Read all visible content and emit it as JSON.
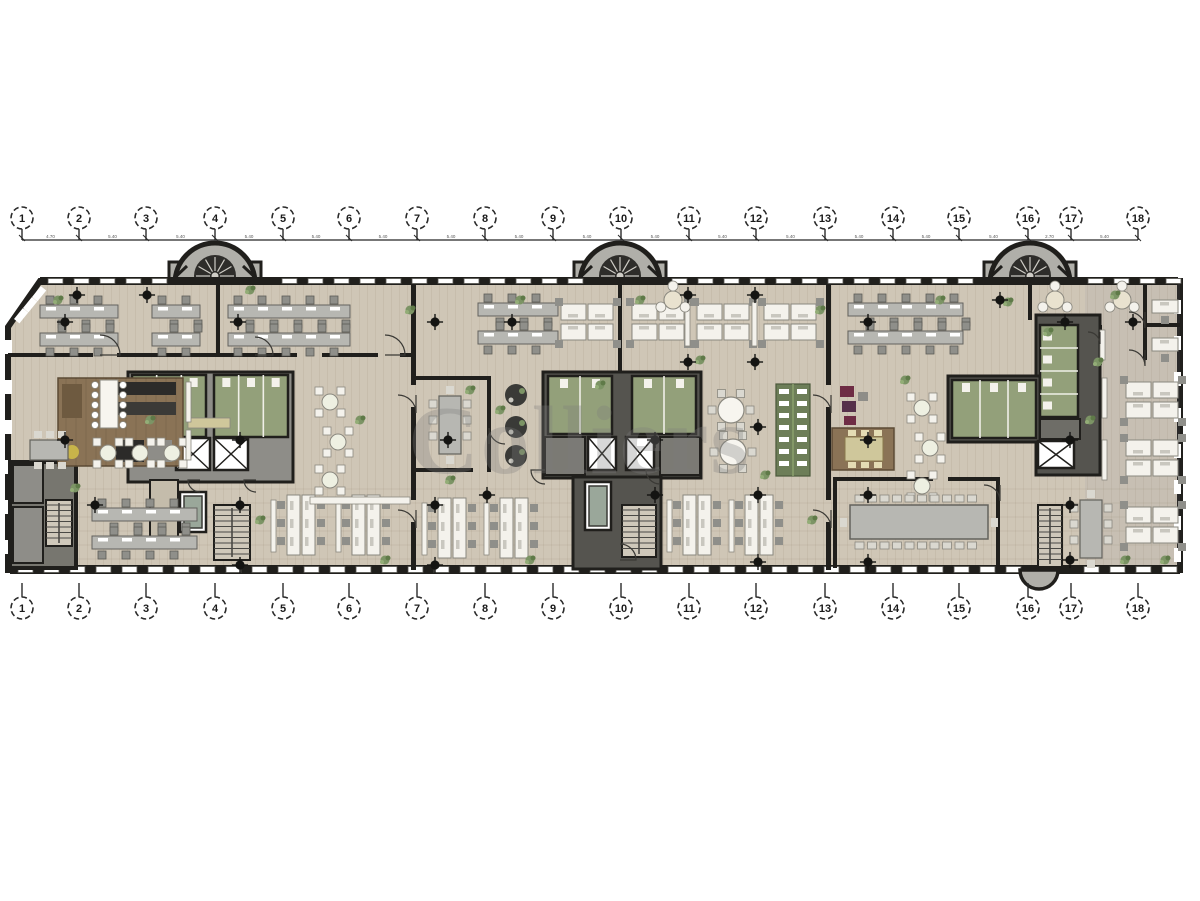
{
  "watermark": {
    "text": "Colliers"
  },
  "palette": {
    "wall": "#201f1c",
    "floor": "#cfc6b6",
    "floor_stripe": "rgba(60,45,20,0.06)",
    "right_tint": "rgba(140,140,155,0.10)",
    "core_dark": "#55544f",
    "core_gray": "#8e8d88",
    "green_room": "#93a07a",
    "green_dark": "#6d7e58",
    "desk_white": "#f4f2ec",
    "desk_gray": "#b7b7b2",
    "chair": "#8f8f8a",
    "chair_light": "#dad8d0",
    "brown": "#8a7356",
    "khaki": "#cfc79b",
    "magenta": "#6e2c44",
    "plant": "#7c9465",
    "tower_gray": "#b0afa9",
    "spiral_dark": "#2e2d2a",
    "spoke": "#cfcdc6",
    "window": "#ffffff",
    "column": "#141412",
    "lift_inner": "#9aa79a",
    "stair_tread": "#cfc8ba"
  },
  "grid": {
    "labels": [
      "1",
      "2",
      "3",
      "4",
      "5",
      "6",
      "7",
      "8",
      "9",
      "10",
      "11",
      "12",
      "13",
      "14",
      "15",
      "16",
      "17",
      "18"
    ],
    "x": [
      22,
      79,
      146,
      215,
      283,
      349,
      417,
      485,
      553,
      621,
      689,
      756,
      825,
      893,
      959,
      1028,
      1071,
      1138
    ],
    "bubble_r": 11,
    "top": {
      "bubble_cy": 218,
      "line_y": 240
    },
    "bottom": {
      "bubble_cy": 608,
      "stem_top": 583
    },
    "dims": [
      "4.70",
      "5.40",
      "5.40",
      "5.40",
      "5.40",
      "5.40",
      "5.40",
      "5.40",
      "5.40",
      "5.40",
      "5.40",
      "5.40",
      "5.40",
      "5.40",
      "5.40",
      "2.70",
      "5.40"
    ]
  },
  "envelope": {
    "points": "40,281 1180,281 1180,570 8,570 8,327"
  },
  "towers": [
    {
      "cx": 215
    },
    {
      "cx": 620
    },
    {
      "cx": 1030
    }
  ],
  "window_bands": {
    "top": {
      "y": 277,
      "h": 8,
      "x0": 48,
      "x1": 1170,
      "skips": [
        [
          168,
          264
        ],
        [
          572,
          670
        ],
        [
          982,
          1078
        ]
      ]
    },
    "bottom": {
      "y": 565,
      "h": 9,
      "x0": 18,
      "x1": 1172,
      "skips": [
        [
          1016,
          1060
        ]
      ]
    },
    "left_ticks_y": [
      340,
      380,
      420,
      460,
      500,
      540
    ],
    "right_ticks_y": [
      300,
      336,
      372,
      408,
      444,
      480,
      516,
      548
    ]
  },
  "walls": [
    [
      8,
      353,
      85,
      4
    ],
    [
      117,
      353,
      180,
      4
    ],
    [
      322,
      353,
      56,
      4
    ],
    [
      400,
      353,
      13,
      4
    ],
    [
      411,
      285,
      5,
      100
    ],
    [
      411,
      407,
      5,
      93
    ],
    [
      411,
      522,
      5,
      48
    ],
    [
      826,
      285,
      5,
      100
    ],
    [
      826,
      407,
      5,
      93
    ],
    [
      826,
      522,
      5,
      48
    ],
    [
      216,
      285,
      4,
      70
    ],
    [
      618,
      285,
      4,
      90
    ],
    [
      1028,
      285,
      4,
      35
    ],
    [
      413,
      376,
      78,
      4
    ],
    [
      413,
      468,
      60,
      4
    ],
    [
      487,
      376,
      4,
      96
    ],
    [
      833,
      477,
      100,
      4
    ],
    [
      948,
      477,
      52,
      4
    ],
    [
      833,
      477,
      4,
      91
    ],
    [
      996,
      477,
      4,
      91
    ],
    [
      1143,
      285,
      4,
      75
    ],
    [
      1143,
      323,
      40,
      4
    ],
    [
      1098,
      325,
      4,
      40
    ]
  ],
  "cores": {
    "left": {
      "bg": [
        128,
        372,
        165,
        110
      ],
      "green": [
        [
          132,
          375,
          74,
          62
        ],
        [
          214,
          375,
          74,
          62
        ]
      ],
      "elevators": [
        [
          176,
          438,
          34,
          32
        ],
        [
          214,
          438,
          34,
          32
        ]
      ],
      "lift": [
        180,
        492,
        26,
        40
      ],
      "stair": [
        214,
        505,
        36,
        55
      ],
      "rooms": [
        [
          150,
          480,
          28,
          60
        ]
      ]
    },
    "center": {
      "bg": [
        543,
        372,
        158,
        106
      ],
      "green": [
        [
          548,
          376,
          64,
          58
        ],
        [
          632,
          376,
          64,
          58
        ]
      ],
      "elevators": [
        [
          588,
          437,
          28,
          33
        ],
        [
          626,
          437,
          28,
          33
        ]
      ],
      "lobbies": [
        [
          545,
          437,
          40,
          38
        ],
        [
          660,
          437,
          40,
          38
        ]
      ],
      "lower_bg": [
        573,
        477,
        88,
        92
      ],
      "lift": [
        585,
        482,
        26,
        48
      ],
      "stair": [
        622,
        505,
        34,
        52
      ]
    },
    "right": {
      "bg": [
        [
          1036,
          315,
          64,
          160
        ],
        [
          948,
          376,
          92,
          66
        ]
      ],
      "green": [
        [
          952,
          380,
          84,
          58
        ],
        [
          1040,
          325,
          38,
          92
        ]
      ],
      "utility": [
        1040,
        419,
        40,
        20
      ],
      "elevators": [
        [
          1038,
          441,
          36,
          27
        ]
      ],
      "stair": [
        1038,
        505,
        24,
        62
      ]
    },
    "southwest": {
      "bg": [
        10,
        462,
        66,
        106
      ],
      "rooms": [
        [
          13,
          465,
          30,
          38
        ],
        [
          13,
          507,
          30,
          56
        ]
      ],
      "stair": [
        46,
        500,
        26,
        46
      ]
    }
  },
  "furniture": [
    {
      "t": "benchH2",
      "x": 40,
      "y": 305,
      "w": 78
    },
    {
      "t": "benchH2",
      "x": 152,
      "y": 305,
      "w": 48
    },
    {
      "t": "benchH2",
      "x": 228,
      "y": 305,
      "w": 122
    },
    {
      "t": "benchH2",
      "x": 478,
      "y": 303,
      "w": 80
    },
    {
      "t": "benchH2",
      "x": 848,
      "y": 303,
      "w": 115
    },
    {
      "t": "quad",
      "x": 587,
      "y": 322
    },
    {
      "t": "quad",
      "x": 658,
      "y": 322
    },
    {
      "t": "quad",
      "x": 723,
      "y": 322
    },
    {
      "t": "quad",
      "x": 790,
      "y": 322
    },
    {
      "t": "strip",
      "x": 685,
      "y": 302,
      "h": 44
    },
    {
      "t": "strip",
      "x": 752,
      "y": 302,
      "h": 44
    },
    {
      "t": "kitchen",
      "x": 58,
      "y": 378
    },
    {
      "t": "island",
      "x": 100,
      "y": 380
    },
    {
      "t": "credenza",
      "x": 188,
      "y": 418,
      "w": 42,
      "h": 10,
      "c": "khaki"
    },
    {
      "t": "table6",
      "x": 30,
      "y": 440
    },
    {
      "t": "roundX",
      "x": 108,
      "y": 453
    },
    {
      "t": "roundX",
      "x": 140,
      "y": 453
    },
    {
      "t": "roundX",
      "x": 172,
      "y": 453
    },
    {
      "t": "roundX",
      "x": 330,
      "y": 402
    },
    {
      "t": "roundX",
      "x": 338,
      "y": 442
    },
    {
      "t": "roundX",
      "x": 330,
      "y": 480
    },
    {
      "t": "roundX",
      "x": 922,
      "y": 408
    },
    {
      "t": "roundX",
      "x": 930,
      "y": 448
    },
    {
      "t": "roundX",
      "x": 922,
      "y": 486
    },
    {
      "t": "benchH2",
      "x": 92,
      "y": 508,
      "w": 105
    },
    {
      "t": "benchV",
      "x": 287,
      "y": 495
    },
    {
      "t": "benchV",
      "x": 352,
      "y": 495
    },
    {
      "t": "benchV",
      "x": 438,
      "y": 498
    },
    {
      "t": "benchV",
      "x": 500,
      "y": 498
    },
    {
      "t": "benchV",
      "x": 683,
      "y": 495
    },
    {
      "t": "benchV",
      "x": 745,
      "y": 495
    },
    {
      "t": "meetV",
      "x": 439,
      "y": 396
    },
    {
      "t": "pod",
      "x": 516,
      "y": 395
    },
    {
      "t": "pod",
      "x": 516,
      "y": 427
    },
    {
      "t": "pod",
      "x": 516,
      "y": 456
    },
    {
      "t": "round6",
      "x": 731,
      "y": 410
    },
    {
      "t": "round6",
      "x": 733,
      "y": 452
    },
    {
      "t": "shelf",
      "x": 776,
      "y": 384,
      "w": 34,
      "h": 92
    },
    {
      "t": "mag",
      "x": 840,
      "y": 386
    },
    {
      "t": "khakiRoom",
      "x": 832,
      "y": 428
    },
    {
      "t": "conf",
      "x": 850,
      "y": 505,
      "w": 138,
      "h": 34
    },
    {
      "t": "tripod",
      "x": 673,
      "y": 300
    },
    {
      "t": "tripod",
      "x": 1055,
      "y": 300
    },
    {
      "t": "tripod",
      "x": 1122,
      "y": 300
    },
    {
      "t": "deskS",
      "x": 1152,
      "y": 300
    },
    {
      "t": "deskS",
      "x": 1152,
      "y": 338
    },
    {
      "t": "quad",
      "x": 1152,
      "y": 400
    },
    {
      "t": "quad",
      "x": 1152,
      "y": 458
    },
    {
      "t": "quad",
      "x": 1152,
      "y": 525
    },
    {
      "t": "strip",
      "x": 1100,
      "y": 330,
      "h": 30
    },
    {
      "t": "strip",
      "x": 1102,
      "y": 378,
      "h": 40
    },
    {
      "t": "strip",
      "x": 1102,
      "y": 440,
      "h": 40
    },
    {
      "t": "meetV",
      "x": 1080,
      "y": 500
    },
    {
      "t": "strip",
      "x": 186,
      "y": 382,
      "h": 40
    },
    {
      "t": "strip",
      "x": 186,
      "y": 430,
      "h": 30
    },
    {
      "t": "credenza",
      "x": 310,
      "y": 497,
      "w": 100,
      "h": 7,
      "c": "desk_white"
    },
    {
      "t": "credenza",
      "x": 600,
      "y": 210,
      "w": 0,
      "h": 0,
      "c": "desk_white"
    }
  ],
  "columns": [
    [
      77,
      295
    ],
    [
      147,
      295
    ],
    [
      65,
      322
    ],
    [
      238,
      322
    ],
    [
      435,
      322
    ],
    [
      512,
      322
    ],
    [
      688,
      295
    ],
    [
      755,
      295
    ],
    [
      688,
      362
    ],
    [
      755,
      362
    ],
    [
      868,
      322
    ],
    [
      1000,
      300
    ],
    [
      1065,
      322
    ],
    [
      1133,
      322
    ],
    [
      65,
      440
    ],
    [
      240,
      440
    ],
    [
      448,
      440
    ],
    [
      655,
      440
    ],
    [
      758,
      427
    ],
    [
      868,
      440
    ],
    [
      1070,
      440
    ],
    [
      95,
      505
    ],
    [
      240,
      505
    ],
    [
      435,
      505
    ],
    [
      487,
      495
    ],
    [
      655,
      495
    ],
    [
      758,
      495
    ],
    [
      868,
      495
    ],
    [
      1070,
      505
    ],
    [
      240,
      565
    ],
    [
      435,
      565
    ],
    [
      758,
      562
    ],
    [
      868,
      562
    ],
    [
      1070,
      560
    ]
  ],
  "plants": [
    [
      58,
      300
    ],
    [
      250,
      290
    ],
    [
      410,
      310
    ],
    [
      470,
      390
    ],
    [
      500,
      410
    ],
    [
      360,
      420
    ],
    [
      150,
      420
    ],
    [
      75,
      488
    ],
    [
      520,
      300
    ],
    [
      600,
      385
    ],
    [
      450,
      480
    ],
    [
      530,
      560
    ],
    [
      820,
      310
    ],
    [
      905,
      380
    ],
    [
      700,
      360
    ],
    [
      765,
      475
    ],
    [
      940,
      300
    ],
    [
      1048,
      332
    ],
    [
      1115,
      295
    ],
    [
      1098,
      362
    ],
    [
      1125,
      560
    ],
    [
      1165,
      560
    ],
    [
      1090,
      420
    ],
    [
      260,
      520
    ],
    [
      385,
      560
    ],
    [
      640,
      300
    ],
    [
      812,
      520
    ],
    [
      1008,
      302
    ]
  ],
  "door_arcs": [
    [
      100,
      355,
      20,
      0
    ],
    [
      385,
      355,
      20,
      0
    ],
    [
      255,
      355,
      18,
      0
    ],
    [
      416,
      395,
      18,
      1
    ],
    [
      831,
      395,
      18,
      1
    ],
    [
      416,
      510,
      18,
      1
    ],
    [
      831,
      510,
      18,
      1
    ],
    [
      489,
      444,
      16,
      3
    ],
    [
      545,
      470,
      14,
      2
    ],
    [
      660,
      470,
      14,
      2
    ],
    [
      1000,
      485,
      16,
      1
    ],
    [
      1145,
      312,
      16,
      1
    ],
    [
      1145,
      350,
      16,
      1
    ],
    [
      1100,
      332,
      12,
      1
    ],
    [
      620,
      560,
      16,
      0
    ],
    [
      200,
      480,
      12,
      2
    ],
    [
      256,
      480,
      12,
      2
    ]
  ]
}
